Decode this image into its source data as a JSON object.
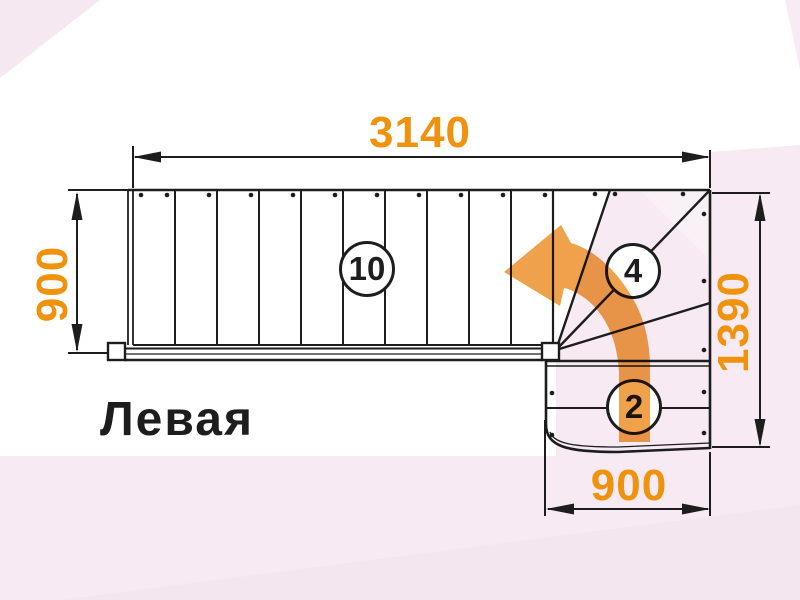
{
  "title_label": "Левая",
  "dimensions": {
    "top_width": "3140",
    "left_height": "900",
    "right_height": "1390",
    "bottom_width": "900"
  },
  "step_counts": {
    "straight_flight": "10",
    "winder": "4",
    "bottom_flight": "2"
  },
  "colors": {
    "dimension_orange": "#EF930F",
    "arrow_orange": "#EFA14B",
    "line_color": "#1D1D1D",
    "background_pink": "#F7EAF3"
  }
}
